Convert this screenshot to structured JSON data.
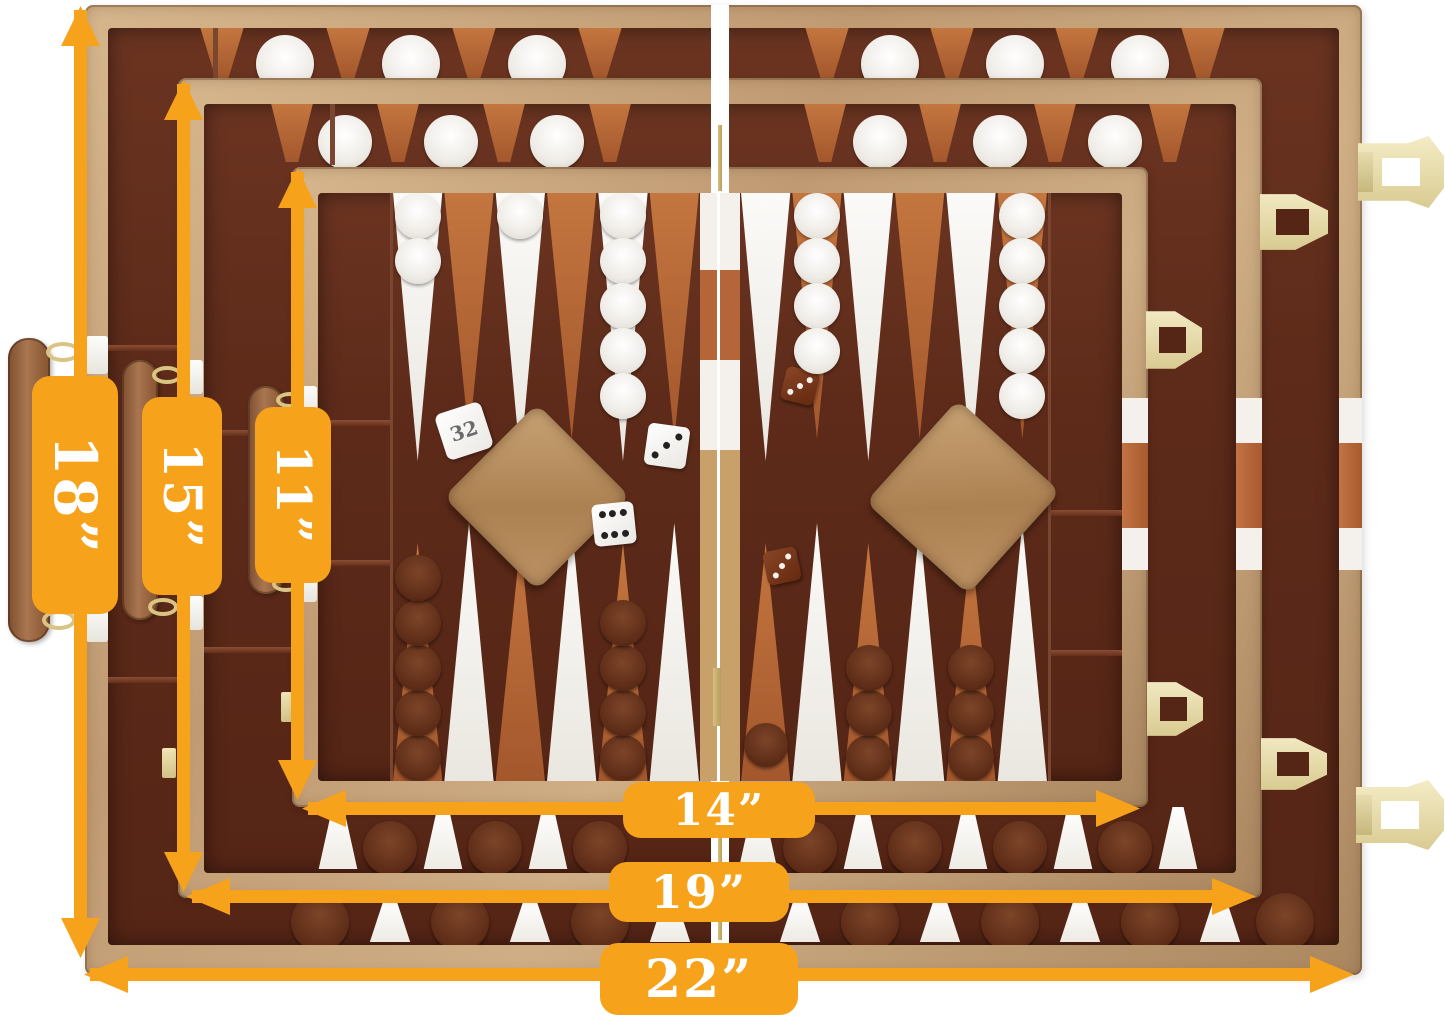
{
  "dimension_labels": {
    "case_large_height": "18”",
    "case_medium_height": "15”",
    "case_small_height": "11”",
    "case_small_width": "14”",
    "case_medium_width": "19”",
    "case_large_width": "22”"
  },
  "doubling_cube_value": "32",
  "dice": {
    "white_die_top_pips": 3,
    "white_die_bottom_pips": 6,
    "brown_die_top_pips": 3,
    "brown_die_bottom_pips": 3
  },
  "colors": {
    "annotation_orange": "#F7A21B",
    "label_text_white": "#FFFFFF",
    "leather_tan": "#C29C74",
    "felt_dark_brown": "#5E2B1A",
    "point_sienna": "#B4663A",
    "point_white": "#F5F3F0",
    "checker_white": "#F2EFEA",
    "checker_brown": "#63301C",
    "hardware_gold": "#E9DFAE",
    "background_white": "#FFFFFF"
  }
}
